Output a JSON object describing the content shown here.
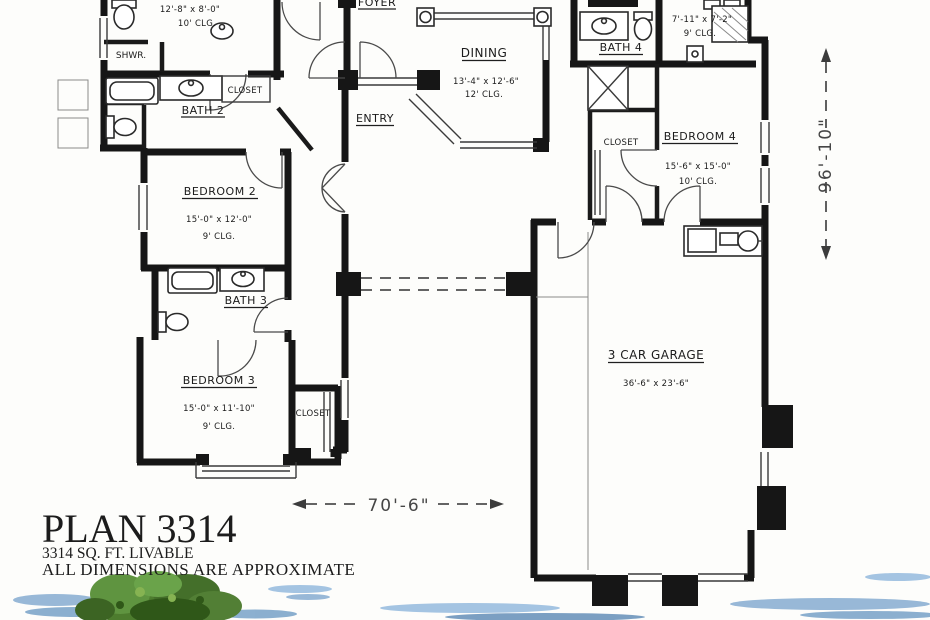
{
  "plan_footer": {
    "title": "PLAN 3314",
    "area": "3314 SQ. FT. LIVABLE",
    "disclaimer": "ALL DIMENSIONS ARE APPROXIMATE"
  },
  "overall_dimensions": {
    "width": "70'-6\"",
    "depth": "96'-10\""
  },
  "rooms": {
    "foyer": {
      "name": "FOYER"
    },
    "entry": {
      "name": "ENTRY"
    },
    "dining": {
      "name": "DINING",
      "size": "13'-4\" x 12'-6\"",
      "ceiling": "12' CLG."
    },
    "master_bath": {
      "size": "12'-8\" x 8'-0\"",
      "ceiling": "10' CLG."
    },
    "shower": {
      "name": "SHWR."
    },
    "bath2": {
      "name": "BATH 2",
      "closet": "CLOSET"
    },
    "bedroom2": {
      "name": "BEDROOM 2",
      "size": "15'-0\" x 12'-0\"",
      "ceiling": "9' CLG."
    },
    "bath3": {
      "name": "BATH 3"
    },
    "bedroom3": {
      "name": "BEDROOM 3",
      "size": "15'-0\" x 11'-10\"",
      "ceiling": "9' CLG.",
      "closet": "CLOSET"
    },
    "bath4": {
      "name": "BATH 4"
    },
    "utility": {
      "size": "7'-11\" x 7'-2\"",
      "ceiling": "9' CLG."
    },
    "bedroom4": {
      "name": "BEDROOM 4",
      "size": "15'-6\" x 15'-0\"",
      "ceiling": "10' CLG.",
      "closet": "CLOSET"
    },
    "garage": {
      "name": "3 CAR GARAGE",
      "size": "36'-6\" x 23'-6\""
    }
  },
  "colors": {
    "walls": "#161616",
    "paper": "#fdfdfb",
    "water": "#7fa8cf",
    "tree": "#4d7c2e",
    "dimension_text": "#454545"
  }
}
